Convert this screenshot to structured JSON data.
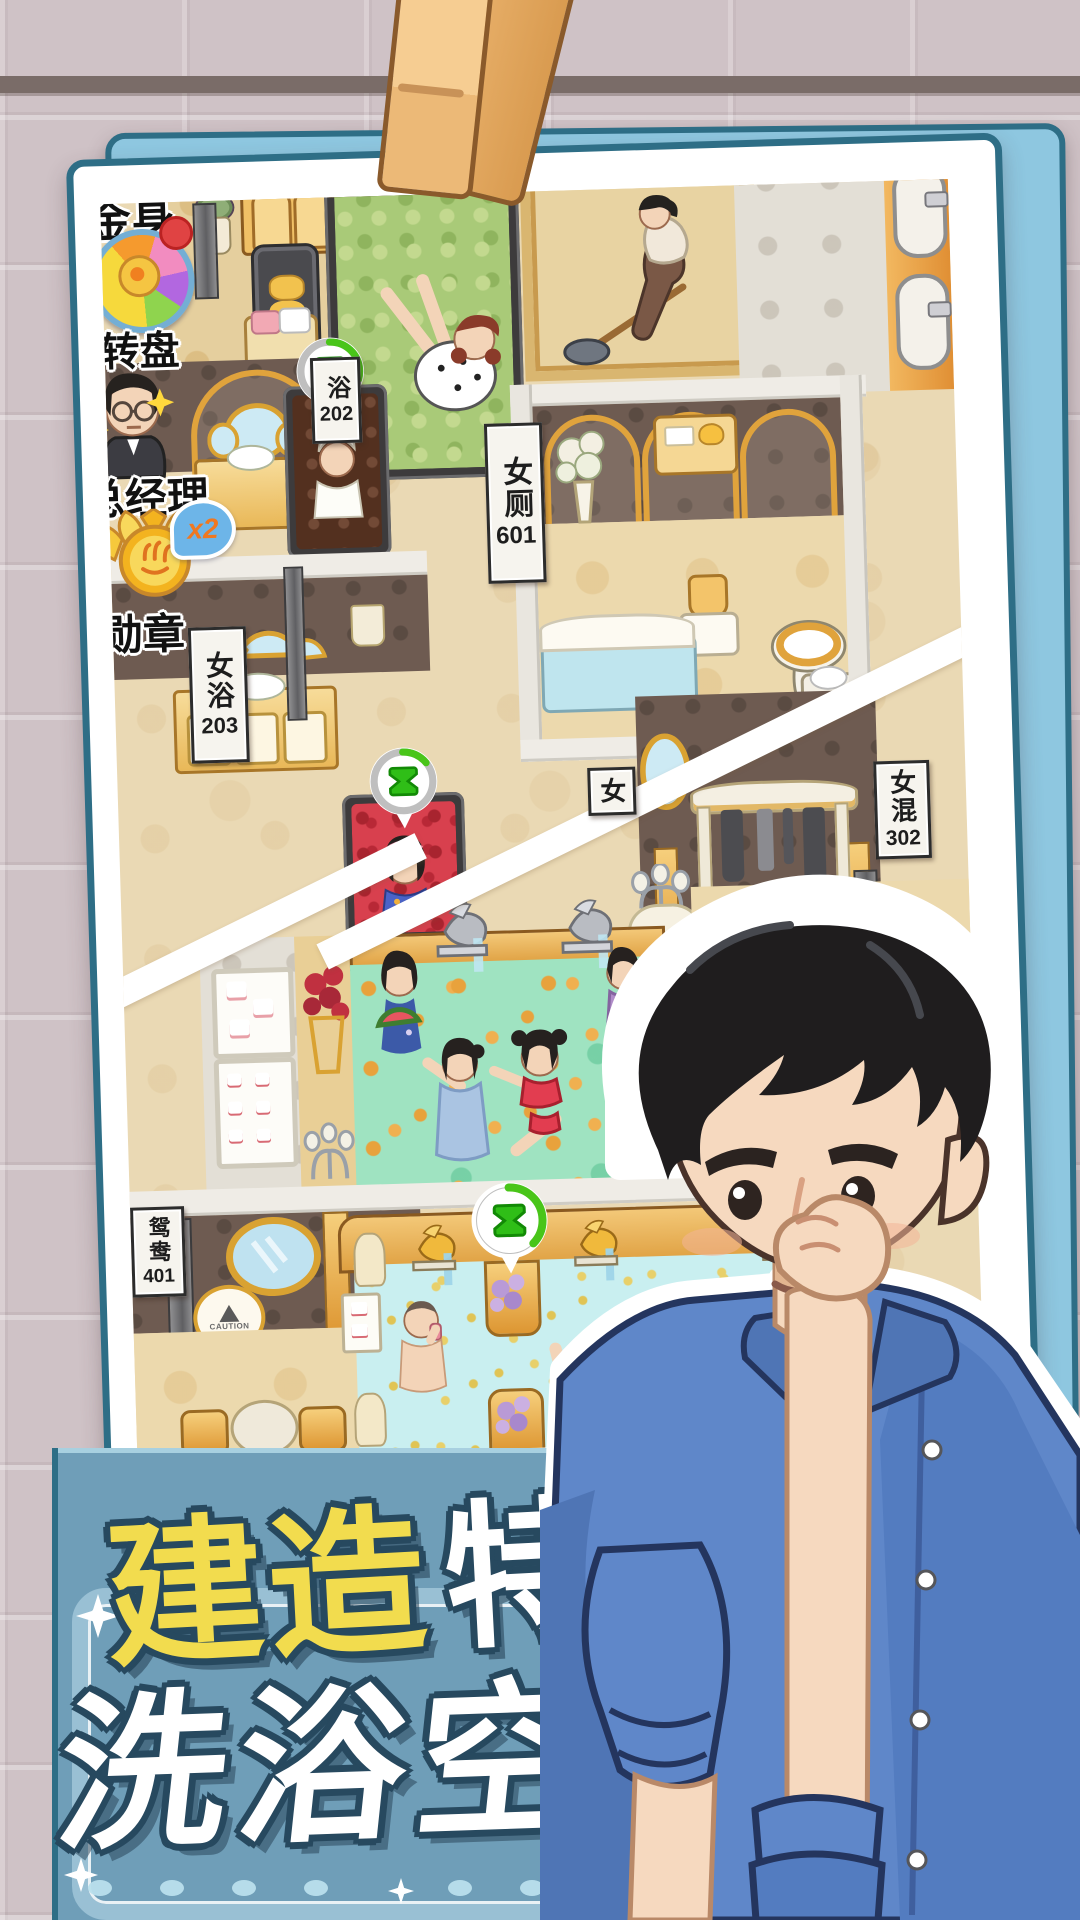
{
  "hud": {
    "cropped_label": "金身",
    "wheel": {
      "label": "转盘"
    },
    "manager": {
      "label": "总经理"
    },
    "medal": {
      "label": "勋章",
      "multiplier": "x2"
    }
  },
  "signs": {
    "r202": {
      "label": "浴",
      "number": "202"
    },
    "r601": {
      "label": "女厕",
      "number": "601"
    },
    "r203": {
      "label": "女浴",
      "number": "203"
    },
    "r302": {
      "label": "女混",
      "number": "302"
    },
    "r401": {
      "label": "鸳鸯",
      "number": "401"
    },
    "partial_female": "女"
  },
  "badges": {
    "rating": "3.0",
    "warning": "!"
  },
  "plaques": {
    "caution": "CAUTION"
  },
  "caption": {
    "word_highlight": "建造",
    "word_rest": "特色",
    "line2": "洗浴空间"
  },
  "colors": {
    "accent_teal": "#2e6e86",
    "card_back": "#8ec7e0",
    "banner_blue": "#6f9eb8",
    "caption_yellow": "#f2dc4e",
    "caption_outline": "#27495f",
    "timer_green": "#49c519",
    "water_green": "#9fe3c1",
    "water_cyan": "#c9eff0",
    "bath_red": "#d8404e",
    "bath_brown": "#53301f",
    "gold": "#e2a84f",
    "rating_orange": "#f07820",
    "rating_blue": "#85b4e8"
  }
}
